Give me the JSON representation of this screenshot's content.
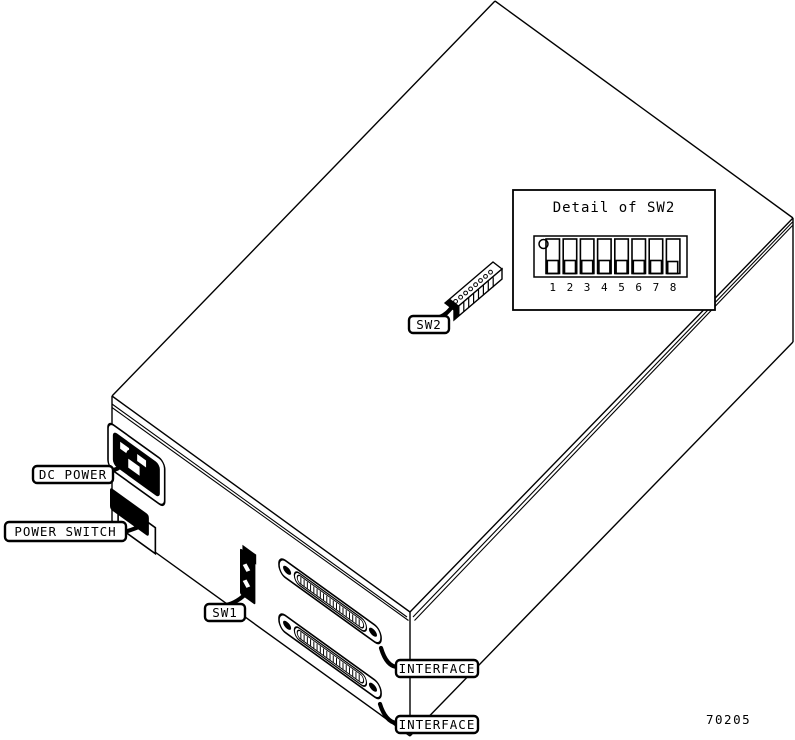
{
  "figure_number": "70205",
  "labels": {
    "dc_power": "DC POWER",
    "power_switch": "POWER SWITCH",
    "sw1": "SW1",
    "sw2": "SW2",
    "interface_top": "INTERFACE",
    "interface_bottom": "INTERFACE"
  },
  "detail": {
    "title": "Detail of SW2",
    "positions": [
      "1",
      "2",
      "3",
      "4",
      "5",
      "6",
      "7",
      "8"
    ]
  },
  "colors": {
    "ink": "#000000",
    "paper": "#ffffff"
  }
}
